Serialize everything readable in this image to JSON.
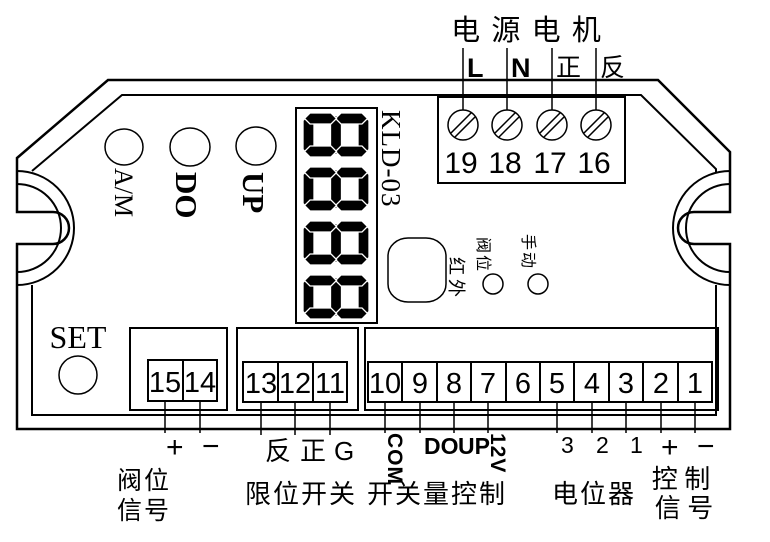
{
  "title": {
    "power_motor": "电 源 电 机"
  },
  "model": "KLD-03",
  "display": {
    "value": "8888"
  },
  "panel_buttons": {
    "am": "A/M",
    "do": "DO",
    "up": "UP",
    "set": "SET"
  },
  "indicators": {
    "infrared": "红外",
    "valve": "阀位",
    "manual": "手动"
  },
  "power": {
    "terminals": [
      {
        "label": "L",
        "number": "19"
      },
      {
        "label": "N",
        "number": "18"
      },
      {
        "label": "正",
        "number": "17"
      },
      {
        "label": "反",
        "number": "16"
      }
    ]
  },
  "valve_signal": {
    "terminals": [
      {
        "number": "15",
        "label": "+"
      },
      {
        "number": "14",
        "label": "−"
      }
    ],
    "caption_line1": "阀位",
    "caption_line2": "信号"
  },
  "limit_switch": {
    "terminals": [
      {
        "number": "13",
        "label": "反"
      },
      {
        "number": "12",
        "label": "正"
      },
      {
        "number": "11",
        "label": "G"
      }
    ],
    "caption": "限位开关"
  },
  "io": {
    "terminals": [
      {
        "number": "10",
        "label": "COM"
      },
      {
        "number": "9",
        "label": "DO"
      },
      {
        "number": "8",
        "label": "UP"
      },
      {
        "number": "7",
        "label": "12V"
      },
      {
        "number": "6",
        "label": ""
      },
      {
        "number": "5",
        "label": "3"
      },
      {
        "number": "4",
        "label": "2"
      },
      {
        "number": "3",
        "label": "1"
      },
      {
        "number": "2",
        "label": "+"
      },
      {
        "number": "1",
        "label": "−"
      }
    ],
    "caption_switch_control": "开关量控制",
    "caption_potentiometer": "电位器",
    "caption_control_line1": "控 制",
    "caption_control_line2": "信 号"
  },
  "colors": {
    "line": "#000000",
    "background": "#ffffff"
  }
}
